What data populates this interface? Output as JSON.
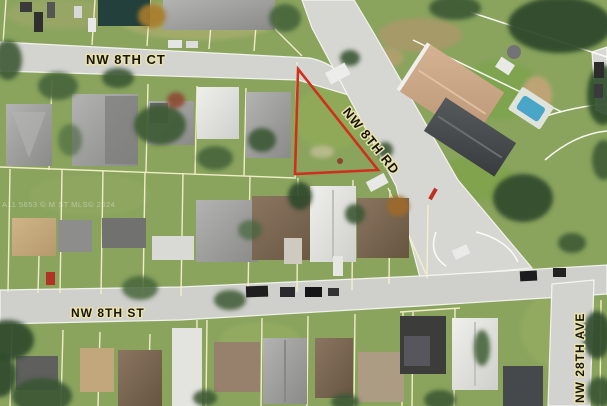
{
  "map": {
    "type": "aerial-parcel-map",
    "labels": {
      "street_top": "NW 8TH CT",
      "street_diagonal": "NW 8TH RD",
      "street_bottom": "NW 8TH ST",
      "street_right": "NW 28TH AVE"
    },
    "watermark": "A11 5653 © M ST   MLS© 2024",
    "highlighted_parcel": {
      "shape": "triangle",
      "outline_color": "#cf2f1d"
    },
    "colors": {
      "parcel_line": "#f6f1cd",
      "parcel_line_white": "#fdfdf8",
      "road": "#d5d5d2",
      "curb": "#f8f8f4",
      "grass": "#8aa45e",
      "pool": "#4aa6c9",
      "label_ink": "#17150c",
      "label_halo": "#e9e2ab",
      "parcel_red": "#cf2f1d"
    }
  }
}
